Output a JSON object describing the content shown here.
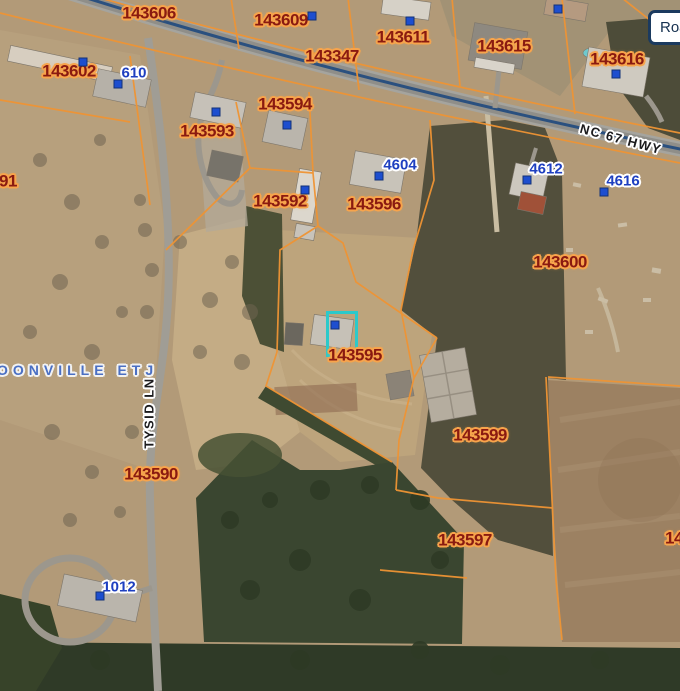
{
  "map": {
    "tool_button": {
      "label": "Roa"
    },
    "parcel_labels": [
      {
        "id": "143606",
        "x": 149,
        "y": 13
      },
      {
        "id": "143609",
        "x": 281,
        "y": 20
      },
      {
        "id": "143611",
        "x": 403,
        "y": 37
      },
      {
        "id": "143347",
        "x": 332,
        "y": 56
      },
      {
        "id": "143615",
        "x": 504,
        "y": 46
      },
      {
        "id": "143616",
        "x": 617,
        "y": 59
      },
      {
        "id": "143602",
        "x": 69,
        "y": 71
      },
      {
        "id": "143593",
        "x": 207,
        "y": 131
      },
      {
        "id": "143594",
        "x": 285,
        "y": 104
      },
      {
        "id": "143592",
        "x": 280,
        "y": 201
      },
      {
        "id": "143596",
        "x": 374,
        "y": 204
      },
      {
        "id": "143600",
        "x": 560,
        "y": 262
      },
      {
        "id": "143595",
        "x": 355,
        "y": 355
      },
      {
        "id": "143590",
        "x": 151,
        "y": 474
      },
      {
        "id": "143599",
        "x": 480,
        "y": 435
      },
      {
        "id": "143597",
        "x": 465,
        "y": 540
      },
      {
        "id": "14",
        "x": 674,
        "y": 538
      },
      {
        "id": "91",
        "x": 8,
        "y": 181
      }
    ],
    "address_labels": [
      {
        "text": "610",
        "x": 134,
        "y": 73
      },
      {
        "text": "4604",
        "x": 400,
        "y": 165
      },
      {
        "text": "4612",
        "x": 546,
        "y": 169
      },
      {
        "text": "4616",
        "x": 623,
        "y": 181
      },
      {
        "text": "1012",
        "x": 119,
        "y": 587
      }
    ],
    "road_labels": [
      {
        "text": "NC 67 HWY",
        "x": 621,
        "y": 139,
        "rot": 15
      },
      {
        "text": "TYSID LN",
        "x": 149,
        "y": 413,
        "rot": -90
      }
    ],
    "area_labels": [
      {
        "text": "BOONVILLE ETJ",
        "x": 70,
        "y": 370
      }
    ],
    "building_markers": [
      {
        "x": 83,
        "y": 62
      },
      {
        "x": 118,
        "y": 84
      },
      {
        "x": 312,
        "y": 16
      },
      {
        "x": 410,
        "y": 21
      },
      {
        "x": 558,
        "y": 9
      },
      {
        "x": 616,
        "y": 74
      },
      {
        "x": 216,
        "y": 112
      },
      {
        "x": 287,
        "y": 125
      },
      {
        "x": 305,
        "y": 190
      },
      {
        "x": 379,
        "y": 176
      },
      {
        "x": 527,
        "y": 180
      },
      {
        "x": 604,
        "y": 192
      },
      {
        "x": 335,
        "y": 325
      },
      {
        "x": 100,
        "y": 596
      }
    ],
    "selected_highlight": {
      "x": 326,
      "y": 311,
      "w": 26,
      "h": 40
    },
    "colors": {
      "parcel_line": "#ef9434",
      "parcel_text": "#8a1a10",
      "parcel_halo": "#f7a44c",
      "address_text": "#1e3fc0",
      "area_text": "#4a6fc3",
      "highlight": "#2cc9ca",
      "road_centerline": "#2a507f",
      "button_border": "#1b3a5f",
      "button_text": "#15304f"
    }
  }
}
